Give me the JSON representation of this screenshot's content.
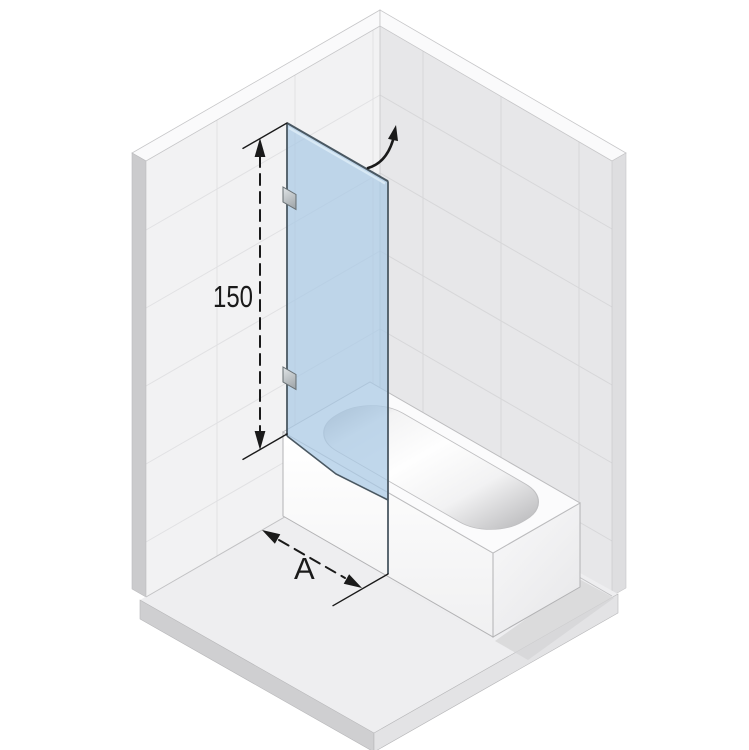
{
  "illustration": {
    "title": "Isometric bath screen over bathtub diagram",
    "labels": {
      "height": "150",
      "width": "A"
    },
    "colors": {
      "background": "#ffffff",
      "glass": "#a9c9e5",
      "glass_edge": "#4a5862",
      "dimension": "#1a1a1a",
      "wall_left": "#f2f2f3",
      "wall_right": "#e7e7e9",
      "wall_top_band": "#fafafb",
      "wall_side_left": "#cbcbcd",
      "wall_side_right": "#dedee0",
      "tile_line_left": "#e1e1e3",
      "tile_line_right": "#d7d7d9",
      "floor": "#eeeef0",
      "floor_edge_left": "#cfcfd1",
      "floor_edge_right": "#e3e3e5",
      "tub": "#fbfbfc",
      "shadow": "#d4d4d6",
      "hinge": "#aeb4b8"
    },
    "icons": {
      "door_swing": "door-swing-arrow"
    }
  }
}
